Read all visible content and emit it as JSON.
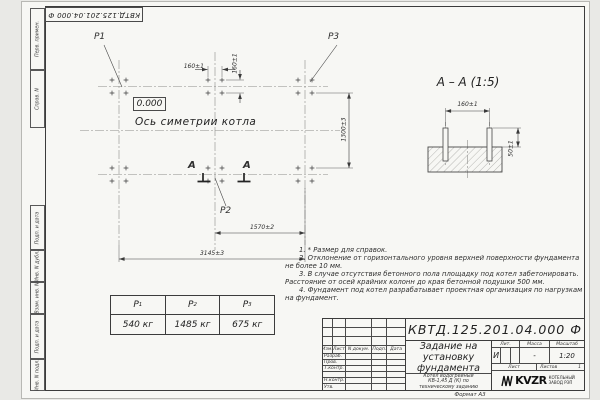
{
  "page": {
    "doc_number_rotated": "КВТД.125.201.04.000 Ф",
    "format_label": "Формат А3"
  },
  "margin_labels": {
    "top": [
      "Перв. примен.",
      "Справ. N"
    ],
    "bottom": [
      "Подп. и дата",
      "Инв. N дубл.",
      "Взам. инв. N",
      "Подп. и дата",
      "Инв. N подл."
    ]
  },
  "plan": {
    "point_labels": {
      "p1": "P1",
      "p2": "P2",
      "p3": "P3"
    },
    "elevation": "0.000",
    "axis_label": "Ось симетрии котла",
    "section_letter": "А",
    "dims": {
      "bolt_spacing_h": "160±1",
      "bolt_spacing_v": "160±1",
      "row_spacing": "1300±3",
      "half_span": "1570±2",
      "full_span": "3145±3"
    }
  },
  "section_view": {
    "title": "А – А (1:5)",
    "dim_width": "160±1",
    "dim_height": "50±1"
  },
  "notes": [
    "1. * Размер для справок.",
    "2. Отклонение от горизонтального уровня верхней поверхности фундамента не более 10 мм.",
    "3. В случае отсутствия бетонного пола площадку под котел забетонировать. Расстояние от осей крайних колонн до края бетонной подушки 500 мм.",
    "4. Фундамент под котел разрабатывает проектная организация по нагрузкам на фундамент."
  ],
  "load_table": {
    "columns": [
      {
        "name": "Р",
        "sub": "1",
        "value": "540 кг"
      },
      {
        "name": "Р",
        "sub": "2",
        "value": "1485 кг"
      },
      {
        "name": "Р",
        "sub": "3",
        "value": "675 кг"
      }
    ]
  },
  "title_block": {
    "doc_number": "КВТД.125.201.04.000  Ф",
    "title": "Задание на установку фундамента",
    "subtitle": "Котел водогрейный КВ-1,45 Д (К) по техническому заданию",
    "rev_header": [
      "Изм.",
      "Лист",
      "N докум.",
      "Подп.",
      "Дата"
    ],
    "sign_labels": [
      "Разраб.",
      "Пров.",
      "Т.контр.",
      "",
      "Н.контр.",
      "Утв."
    ],
    "lit": {
      "label": "Лит.",
      "value": "И"
    },
    "mass": {
      "label": "Масса",
      "value": "-"
    },
    "scale": {
      "label": "Масштаб",
      "value": "1:20"
    },
    "sheet": {
      "label": "Лист",
      "total_label": "Листов",
      "total_value": "1"
    },
    "company": {
      "abbr": "KVZR",
      "line1": "КОТЕЛЬНЫЙ",
      "line2": "ЗАВОД РЭП"
    }
  }
}
